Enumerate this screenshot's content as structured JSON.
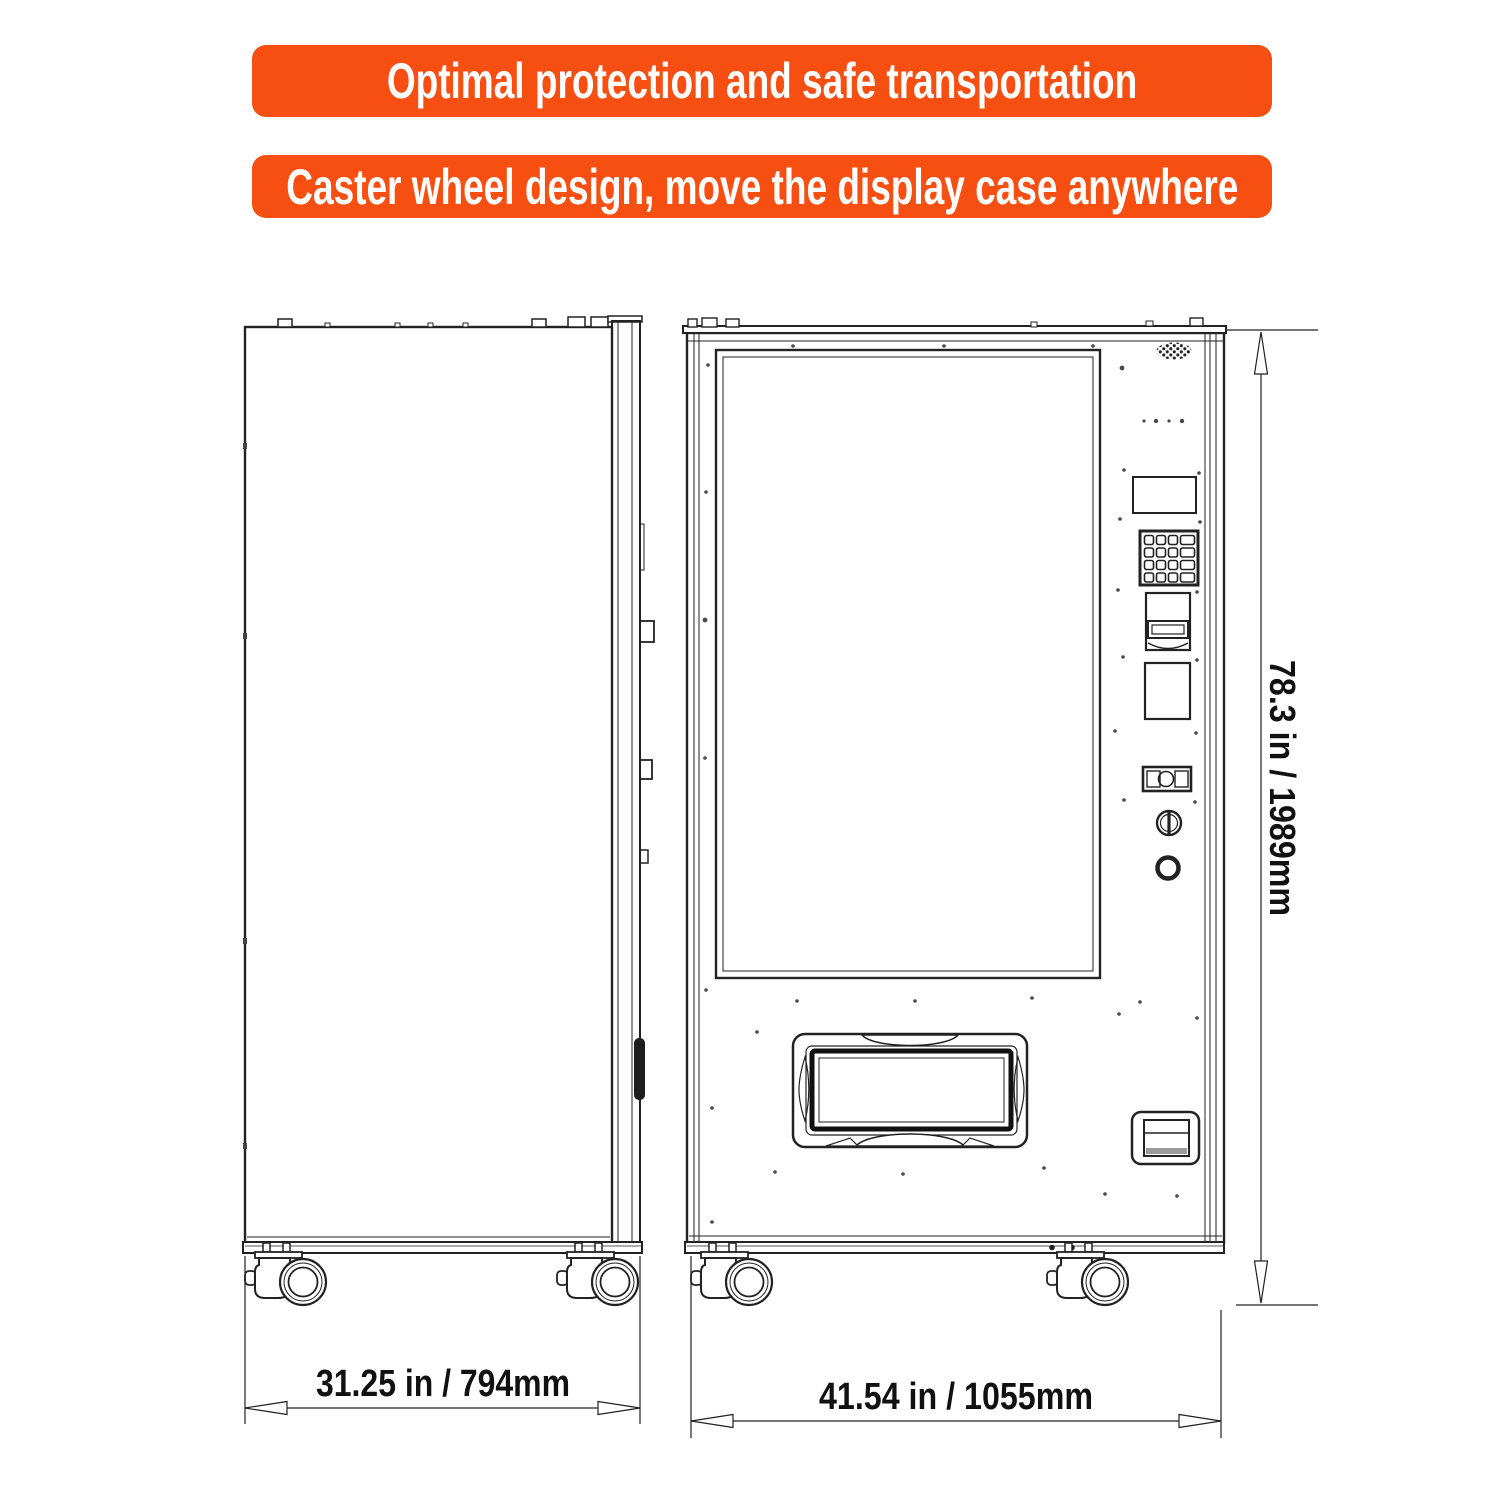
{
  "banners": {
    "top": "Optimal protection and safe transportation",
    "bottom": "Caster wheel design, move the display case anywhere"
  },
  "dimensions": {
    "side_width_label": "31.25 in / 794mm",
    "front_width_label": "41.54 in / 1055mm",
    "height_label": "78.3 in / 1989mm"
  },
  "colors": {
    "banner_bg": "#F74E11",
    "banner_text": "#FFFFFF",
    "line_art": "#222222"
  },
  "icons": [
    "caster-wheel-icon",
    "speaker-grille-icon",
    "keypad-icon",
    "bill-acceptor-icon",
    "card-reader-panel",
    "coin-slot-icon",
    "key-lock-icon",
    "coin-return-icon",
    "delivery-port",
    "receipt-slot-icon"
  ]
}
